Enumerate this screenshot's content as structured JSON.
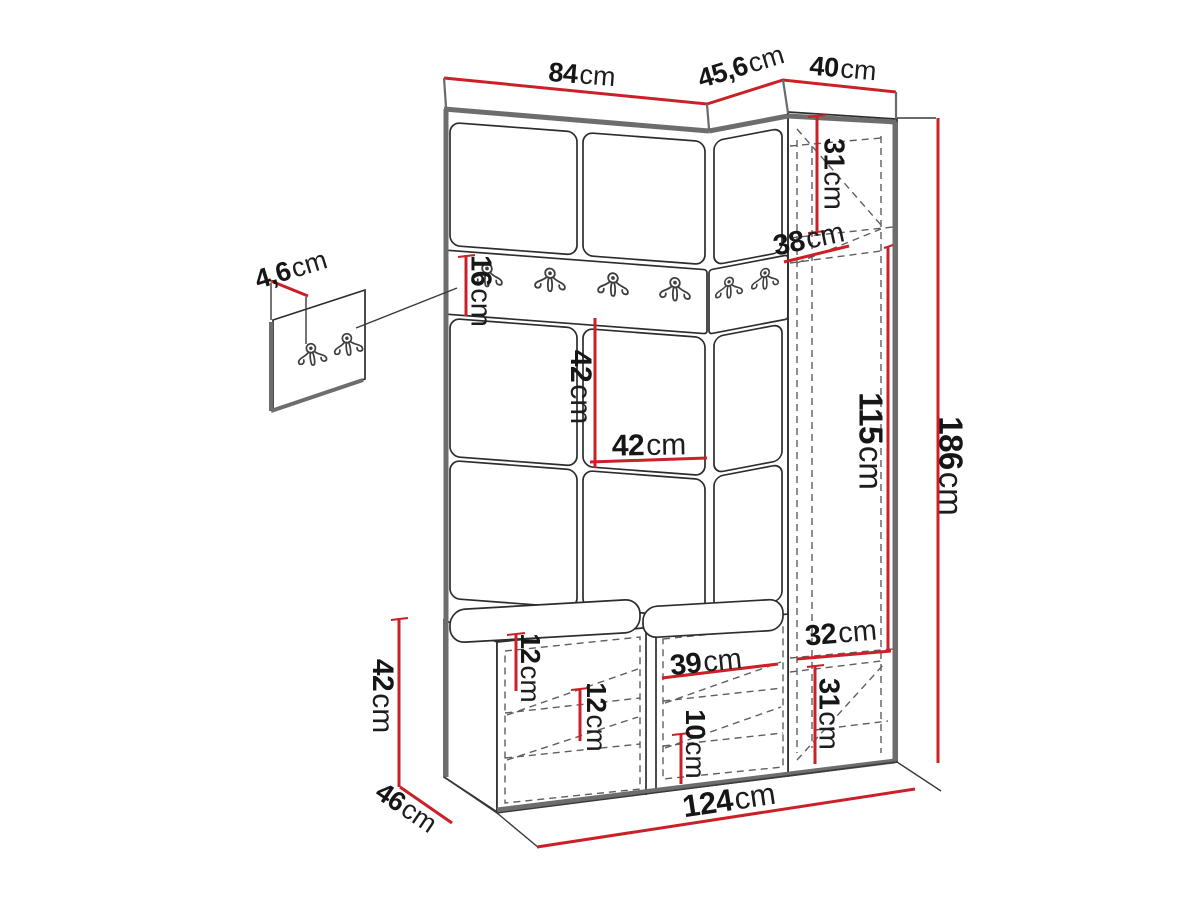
{
  "diagram": {
    "type": "furniture-dimension-drawing",
    "subject": "hallway wardrobe set with coat hooks, bench and corner wardrobe",
    "unit_suffix": "cm",
    "labels": {
      "top_84": {
        "value": "84",
        "unit": "cm"
      },
      "top_45_6": {
        "value": "45,6",
        "unit": "cm"
      },
      "top_40": {
        "value": "40",
        "unit": "cm"
      },
      "right_31_top": {
        "value": "31",
        "unit": "cm"
      },
      "right_38": {
        "value": "38",
        "unit": "cm"
      },
      "rail_16": {
        "value": "16",
        "unit": "cm"
      },
      "hook_panel_4_6": {
        "value": "4,6",
        "unit": "cm"
      },
      "panel_42_height": {
        "value": "42",
        "unit": "cm"
      },
      "panel_42_width": {
        "value": "42",
        "unit": "cm"
      },
      "right_115": {
        "value": "115",
        "unit": "cm"
      },
      "total_height_186": {
        "value": "186",
        "unit": "cm"
      },
      "right_32": {
        "value": "32",
        "unit": "cm"
      },
      "right_31_bottom": {
        "value": "31",
        "unit": "cm"
      },
      "bench_height_42": {
        "value": "42",
        "unit": "cm"
      },
      "bench_depth_46": {
        "value": "46",
        "unit": "cm"
      },
      "bench_12_top": {
        "value": "12",
        "unit": "cm"
      },
      "bench_12_inner": {
        "value": "12",
        "unit": "cm"
      },
      "bench_39": {
        "value": "39",
        "unit": "cm"
      },
      "bench_10": {
        "value": "10",
        "unit": "cm"
      },
      "total_width_124": {
        "value": "124",
        "unit": "cm"
      }
    },
    "colors": {
      "dimension_line": "#cb2027",
      "outline": "#2d2d2d",
      "edge_gray": "#6d6d6d",
      "hidden_line": "#5f5f5f",
      "text": "#161616",
      "background": "#ffffff"
    }
  }
}
